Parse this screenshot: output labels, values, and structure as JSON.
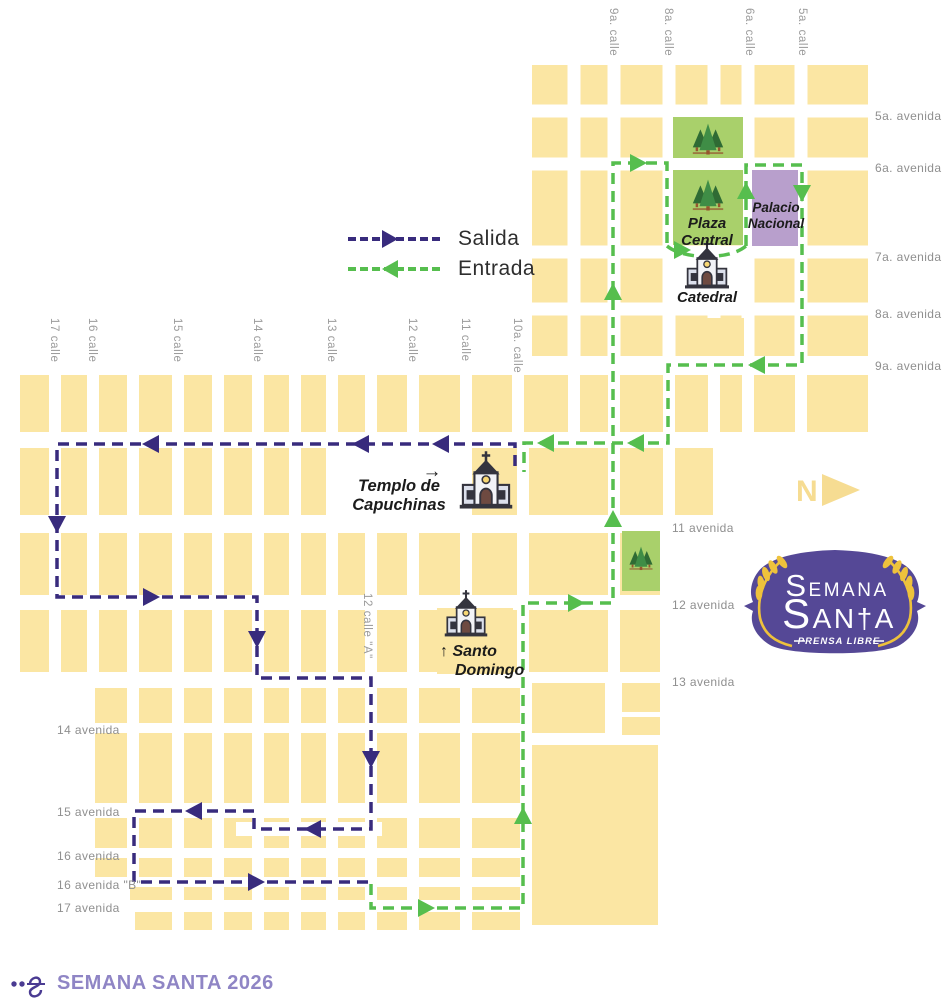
{
  "colors": {
    "block": "#FBE6A3",
    "street_label": "#9B9B9B",
    "avenue_label": "#8F8F8F",
    "landmark_label": "#1B1B1B",
    "salida": "#382B7D",
    "entrada": "#56BE4E",
    "park": "#A9D06B",
    "tree_dark": "#2F6B34",
    "tree_mid": "#3F8D46",
    "trunk": "#96562F",
    "palacio": "#B89FCC",
    "compass": "#F6DC92",
    "logo_bg": "#554896",
    "wheat": "#EEC23C",
    "church_dark": "#34343E",
    "church_light": "#F2F3F7",
    "church_mid": "#DCE0EC",
    "door": "#6E4A41",
    "window_yellow": "#F7D774",
    "footer_text": "#8F85C5",
    "flourish": "#4A3B92",
    "legend_text": "#2E2E2E"
  },
  "legend": {
    "items": [
      {
        "label": "Salida",
        "direction": "right",
        "color_key": "salida"
      },
      {
        "label": "Entrada",
        "direction": "left",
        "color_key": "entrada"
      }
    ]
  },
  "streets": {
    "top_calles": [
      {
        "name": "9a. calle",
        "x": 614
      },
      {
        "name": "8a. calle",
        "x": 669
      },
      {
        "name": "6a. calle",
        "x": 750
      },
      {
        "name": "5a. calle",
        "x": 803
      }
    ],
    "left_calles": [
      {
        "name": "17 calle",
        "x": 55
      },
      {
        "name": "16 calle",
        "x": 93
      },
      {
        "name": "15 calle",
        "x": 178
      },
      {
        "name": "14 calle",
        "x": 258
      },
      {
        "name": "13 calle",
        "x": 332
      },
      {
        "name": "12 calle",
        "x": 413
      },
      {
        "name": "11 calle",
        "x": 466
      },
      {
        "name": "10a. calle",
        "x": 518
      }
    ],
    "calle_a": {
      "name": "12 calle \"A\"",
      "x": 368,
      "y": 593
    },
    "right_avenidas": [
      {
        "name": "5a. avenida",
        "y": 116
      },
      {
        "name": "6a. avenida",
        "y": 168
      },
      {
        "name": "7a. avenida",
        "y": 257
      },
      {
        "name": "8a. avenida",
        "y": 314
      },
      {
        "name": "9a. avenida",
        "y": 366
      }
    ],
    "mid_avenidas": [
      {
        "name": "11 avenida",
        "y": 528
      },
      {
        "name": "12 avenida",
        "y": 605
      },
      {
        "name": "13 avenida",
        "y": 682
      }
    ],
    "left_avenidas": [
      {
        "name": "14 avenida",
        "y": 730
      },
      {
        "name": "15 avenida",
        "y": 812
      },
      {
        "name": "16 avenida",
        "y": 856
      },
      {
        "name": "16 avenida \"B\"",
        "y": 885
      },
      {
        "name": "17 avenida",
        "y": 908
      }
    ]
  },
  "landmarks": {
    "labels": [
      {
        "id": "plaza-central",
        "lines": [
          "Plaza",
          "Central"
        ],
        "x": 707,
        "y": 228,
        "size": 15,
        "anchor": "middle",
        "lh": 17,
        "dx": [
          0,
          0
        ]
      },
      {
        "id": "palacio-nacional",
        "lines": [
          "Palacio",
          "Nacional"
        ],
        "x": 776,
        "y": 212,
        "size": 13.5,
        "anchor": "middle",
        "lh": 16,
        "dx": [
          0,
          0
        ]
      },
      {
        "id": "catedral",
        "lines": [
          "Catedral"
        ],
        "x": 707,
        "y": 302,
        "size": 15,
        "anchor": "middle",
        "lh": 17,
        "dx": [
          0
        ]
      },
      {
        "id": "templo-de-capuchinas",
        "lines": [
          "Templo de",
          "Capuchinas"
        ],
        "x": 399,
        "y": 491,
        "size": 16.5,
        "anchor": "middle",
        "lh": 19,
        "dx": [
          0,
          0
        ]
      },
      {
        "id": "santo-domingo",
        "lines": [
          "↑ Santo",
          "Domingo"
        ],
        "x": 440,
        "y": 656,
        "size": 16,
        "anchor": "start",
        "lh": 19,
        "dx": [
          0,
          15
        ]
      }
    ],
    "annotation_arrow": {
      "glyph": "→",
      "x": 432,
      "y": 477
    },
    "churches": [
      {
        "id": "catedral",
        "cx": 707,
        "base_y": 288,
        "s": 0.88
      },
      {
        "id": "templo-de-capuchinas",
        "cx": 486,
        "base_y": 508,
        "s": 1.05
      },
      {
        "id": "santo-domingo",
        "cx": 466,
        "base_y": 636,
        "s": 0.85
      }
    ]
  },
  "compass": {
    "letter": "N",
    "x": 796,
    "y": 501
  },
  "logo": {
    "line1": "SEMANA",
    "line2": "SAN†A",
    "sub": "PRENSA LIBRE"
  },
  "footer": {
    "title": "SEMANA SANTA 2026"
  },
  "map": {
    "regions": [
      {
        "x": 532,
        "y": 65,
        "w": 336,
        "h": 291,
        "v": [
          574,
          614,
          669,
          714,
          748,
          801
        ],
        "hz": [
          111,
          164,
          252,
          309
        ],
        "sw": 13
      },
      {
        "x": 20,
        "y": 375,
        "w": 848,
        "h": 57,
        "v": [
          55,
          93,
          133,
          178,
          218,
          258,
          295,
          332,
          371,
          413,
          466,
          518,
          574,
          614,
          669,
          714,
          748,
          801
        ],
        "hz": [],
        "sw": 12
      },
      {
        "x": 20,
        "y": 448,
        "w": 693,
        "h": 67,
        "v": [
          55,
          93,
          133,
          178,
          218,
          258,
          295,
          332,
          371,
          413,
          466,
          523,
          614,
          669
        ],
        "hz": [],
        "sw": 12
      },
      {
        "x": 20,
        "y": 533,
        "w": 640,
        "h": 62,
        "v": [
          55,
          93,
          133,
          178,
          218,
          258,
          295,
          332,
          371,
          413,
          466,
          523,
          614
        ],
        "hz": [],
        "sw": 12
      },
      {
        "x": 20,
        "y": 610,
        "w": 640,
        "h": 62,
        "v": [
          55,
          93,
          133,
          178,
          218,
          258,
          295,
          332,
          371,
          413,
          466,
          523,
          614
        ],
        "hz": [],
        "sw": 12
      },
      {
        "x": 95,
        "y": 688,
        "w": 425,
        "h": 35,
        "v": [
          133,
          178,
          218,
          258,
          295,
          332,
          371,
          413,
          466
        ],
        "hz": [],
        "sw": 12
      },
      {
        "x": 95,
        "y": 733,
        "w": 425,
        "h": 70,
        "v": [
          133,
          178,
          218,
          258,
          295,
          332,
          371,
          413,
          466
        ],
        "hz": [],
        "sw": 12
      },
      {
        "x": 95,
        "y": 818,
        "w": 425,
        "h": 30,
        "v": [
          133,
          178,
          218,
          258,
          295,
          332,
          371,
          413,
          466
        ],
        "hz": [],
        "sw": 12
      },
      {
        "x": 95,
        "y": 858,
        "w": 425,
        "h": 19,
        "v": [
          133,
          178,
          218,
          258,
          295,
          332,
          371,
          413,
          466
        ],
        "hz": [],
        "sw": 12
      },
      {
        "x": 130,
        "y": 887,
        "w": 390,
        "h": 13,
        "v": [
          178,
          218,
          258,
          295,
          332,
          371,
          413,
          466
        ],
        "hz": [],
        "sw": 12
      },
      {
        "x": 135,
        "y": 912,
        "w": 385,
        "h": 18,
        "v": [
          178,
          218,
          258,
          295,
          332,
          371,
          413,
          466
        ],
        "hz": [],
        "sw": 12
      }
    ],
    "whiteouts": [
      [
        334,
        446,
        128,
        70
      ],
      [
        663,
        246,
        88,
        60
      ],
      [
        236,
        822,
        146,
        14
      ]
    ],
    "extra_blocks": [
      [
        532,
        683,
        73,
        50
      ],
      [
        622,
        683,
        38,
        29
      ],
      [
        622,
        717,
        38,
        18
      ],
      [
        532,
        745,
        126,
        180
      ],
      [
        437,
        608,
        76,
        66
      ],
      [
        678,
        318,
        66,
        38
      ]
    ],
    "parks": [
      [
        673,
        117,
        70,
        41
      ],
      [
        673,
        170,
        70,
        75
      ],
      [
        622,
        531,
        38,
        60
      ]
    ],
    "trees": [
      {
        "x": 708,
        "y": 136,
        "s": 0.95
      },
      {
        "x": 708,
        "y": 192,
        "s": 0.95
      },
      {
        "x": 641,
        "y": 556,
        "s": 0.72
      }
    ],
    "palacio": [
      752,
      170,
      46,
      76
    ],
    "routes": {
      "salida": {
        "points": [
          [
            515,
            466
          ],
          [
            515,
            444
          ],
          [
            57,
            444
          ],
          [
            57,
            597
          ],
          [
            257,
            597
          ],
          [
            257,
            678
          ],
          [
            371,
            678
          ],
          [
            371,
            829
          ],
          [
            254,
            829
          ],
          [
            254,
            811
          ],
          [
            134,
            811
          ],
          [
            134,
            882
          ],
          [
            371,
            882
          ]
        ],
        "arrows": [
          [
            442,
            444,
            "left"
          ],
          [
            362,
            444,
            "left"
          ],
          [
            152,
            444,
            "left"
          ],
          [
            57,
            523,
            "down"
          ],
          [
            150,
            597,
            "right"
          ],
          [
            257,
            638,
            "down"
          ],
          [
            371,
            758,
            "down"
          ],
          [
            314,
            829,
            "left"
          ],
          [
            195,
            811,
            "left"
          ],
          [
            255,
            882,
            "right"
          ]
        ]
      },
      "entrada": {
        "polylines": [
          [
            [
              371,
              884
            ],
            [
              371,
              908
            ],
            [
              523,
              908
            ],
            [
              523,
              603
            ],
            [
              613,
              603
            ],
            [
              613,
              163
            ],
            [
              667,
              163
            ],
            [
              667,
              246
            ]
          ],
          [
            [
              746,
              246
            ],
            [
              746,
              165
            ],
            [
              802,
              165
            ],
            [
              802,
              365
            ],
            [
              668,
              365
            ],
            [
              668,
              443
            ],
            [
              524,
              443
            ],
            [
              524,
              472
            ]
          ]
        ],
        "curve": "M667,246 C684,260 730,260 746,246",
        "arrows": [
          [
            425,
            908,
            "right"
          ],
          [
            523,
            817,
            "up"
          ],
          [
            575,
            603,
            "right"
          ],
          [
            613,
            520,
            "up"
          ],
          [
            613,
            293,
            "up"
          ],
          [
            637,
            163,
            "right"
          ],
          [
            681,
            250,
            "right"
          ],
          [
            746,
            192,
            "up"
          ],
          [
            802,
            192,
            "down"
          ],
          [
            758,
            365,
            "left"
          ],
          [
            637,
            443,
            "left"
          ],
          [
            547,
            443,
            "left"
          ]
        ]
      }
    }
  }
}
